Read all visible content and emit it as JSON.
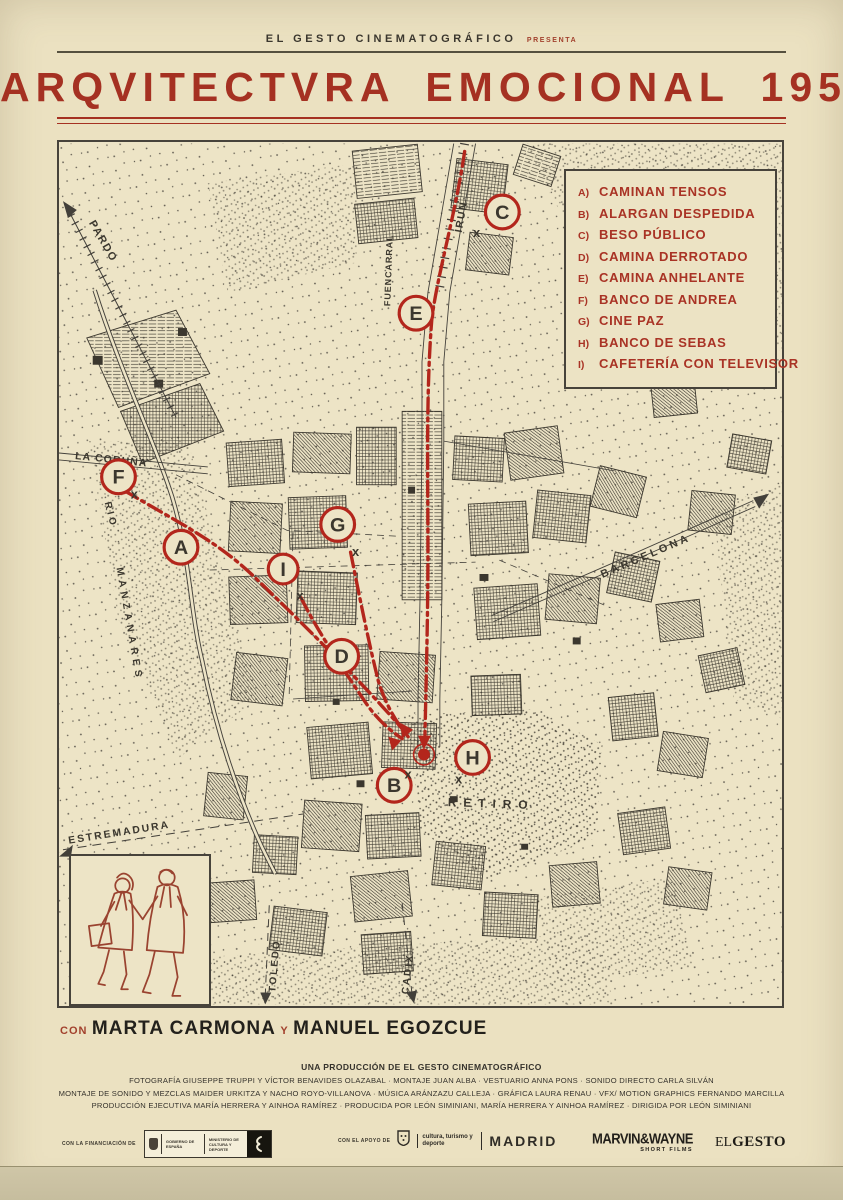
{
  "colors": {
    "paper": "#ebe1c1",
    "map_paper": "#ede4c6",
    "ink": "#3b372e",
    "accent_red": "#a93325",
    "route_red": "#b3261c"
  },
  "header": {
    "studio": "EL GESTO CINEMATOGRÁFICO",
    "presents": "PRESENTA"
  },
  "title": {
    "text": "ARQVITECTVRA EMOCIONAL 1959"
  },
  "legend": {
    "items": [
      {
        "key": "A)",
        "label": "CAMINAN TENSOS"
      },
      {
        "key": "B)",
        "label": "ALARGAN DESPEDIDA"
      },
      {
        "key": "C)",
        "label": "BESO PÚBLICO"
      },
      {
        "key": "D)",
        "label": "CAMINA DERROTADO"
      },
      {
        "key": "E)",
        "label": "CAMINA ANHELANTE"
      },
      {
        "key": "F)",
        "label": "BANCO DE ANDREA"
      },
      {
        "key": "G)",
        "label": "CINE PAZ"
      },
      {
        "key": "H)",
        "label": "BANCO DE SEBAS"
      },
      {
        "key": "I)",
        "label": "CAFETERÍA CON TELEVISOR"
      }
    ]
  },
  "map": {
    "x_mark": "x",
    "markers": [
      {
        "letter": "A"
      },
      {
        "letter": "B"
      },
      {
        "letter": "C"
      },
      {
        "letter": "D"
      },
      {
        "letter": "E"
      },
      {
        "letter": "F"
      },
      {
        "letter": "G"
      },
      {
        "letter": "H"
      },
      {
        "letter": "I"
      }
    ],
    "labels": {
      "pardo": "PARDO",
      "fuencarral": "FUENCARRAL",
      "irun": "IRUN",
      "la_coruna": "LA CORUÑA",
      "rio": "RIO",
      "manzanares": "MANZANARES",
      "barcelona": "BARCELONA",
      "estremadura": "ESTREMADURA",
      "toledo": "TOLEDO",
      "cadix": "CADIX",
      "retiro": "RETIRO"
    }
  },
  "cast": {
    "con": "CON",
    "name1": "MARTA CARMONA",
    "y": "Y",
    "name2": "MANUEL EGOZCUE"
  },
  "credits": {
    "production": "UNA PRODUCCIÓN DE EL GESTO CINEMATOGRÁFICO",
    "line2": "FOTOGRAFÍA GIUSEPPE TRUPPI Y VÍCTOR BENAVIDES OLAZABAL  ·  MONTAJE JUAN ALBA  ·  VESTUARIO ANNA PONS  ·  SONIDO DIRECTO CARLA SILVÁN",
    "line3": "MONTAJE DE SONIDO Y MEZCLAS MAIDER URKITZA Y NACHO ROYO-VILLANOVA  ·  MÚSICA ARÁNZAZU CALLEJA  ·  GRÁFICA LAURA RENAU  ·  VFX/ MOTION GRAPHICS FERNANDO MARCILLA",
    "line4": "PRODUCCIÓN EJECUTIVA MARÍA HERRERA Y AINHOA RAMÍREZ  ·  PRODUCIDA POR LEÓN SIMINIANI,  MARÍA HERRERA Y AINHOA RAMÍREZ  ·  DIRIGIDA POR LEÓN SIMINIANI"
  },
  "footer": {
    "financing_label": "CON LA FINANCIACIÓN DE",
    "gov_line1": "GOBIERNO DE ESPAÑA",
    "gov_line2": "MINISTERIO DE CULTURA Y DEPORTE",
    "support_label": "CON EL APOYO DE",
    "madrid_dept": "cultura, turismo y deporte",
    "madrid_name": "MADRID",
    "dist_name": "MARVIN&WAYNE",
    "dist_sub": "SHORT FILMS",
    "brand_el": "EL",
    "brand_gesto": "GESTO"
  }
}
